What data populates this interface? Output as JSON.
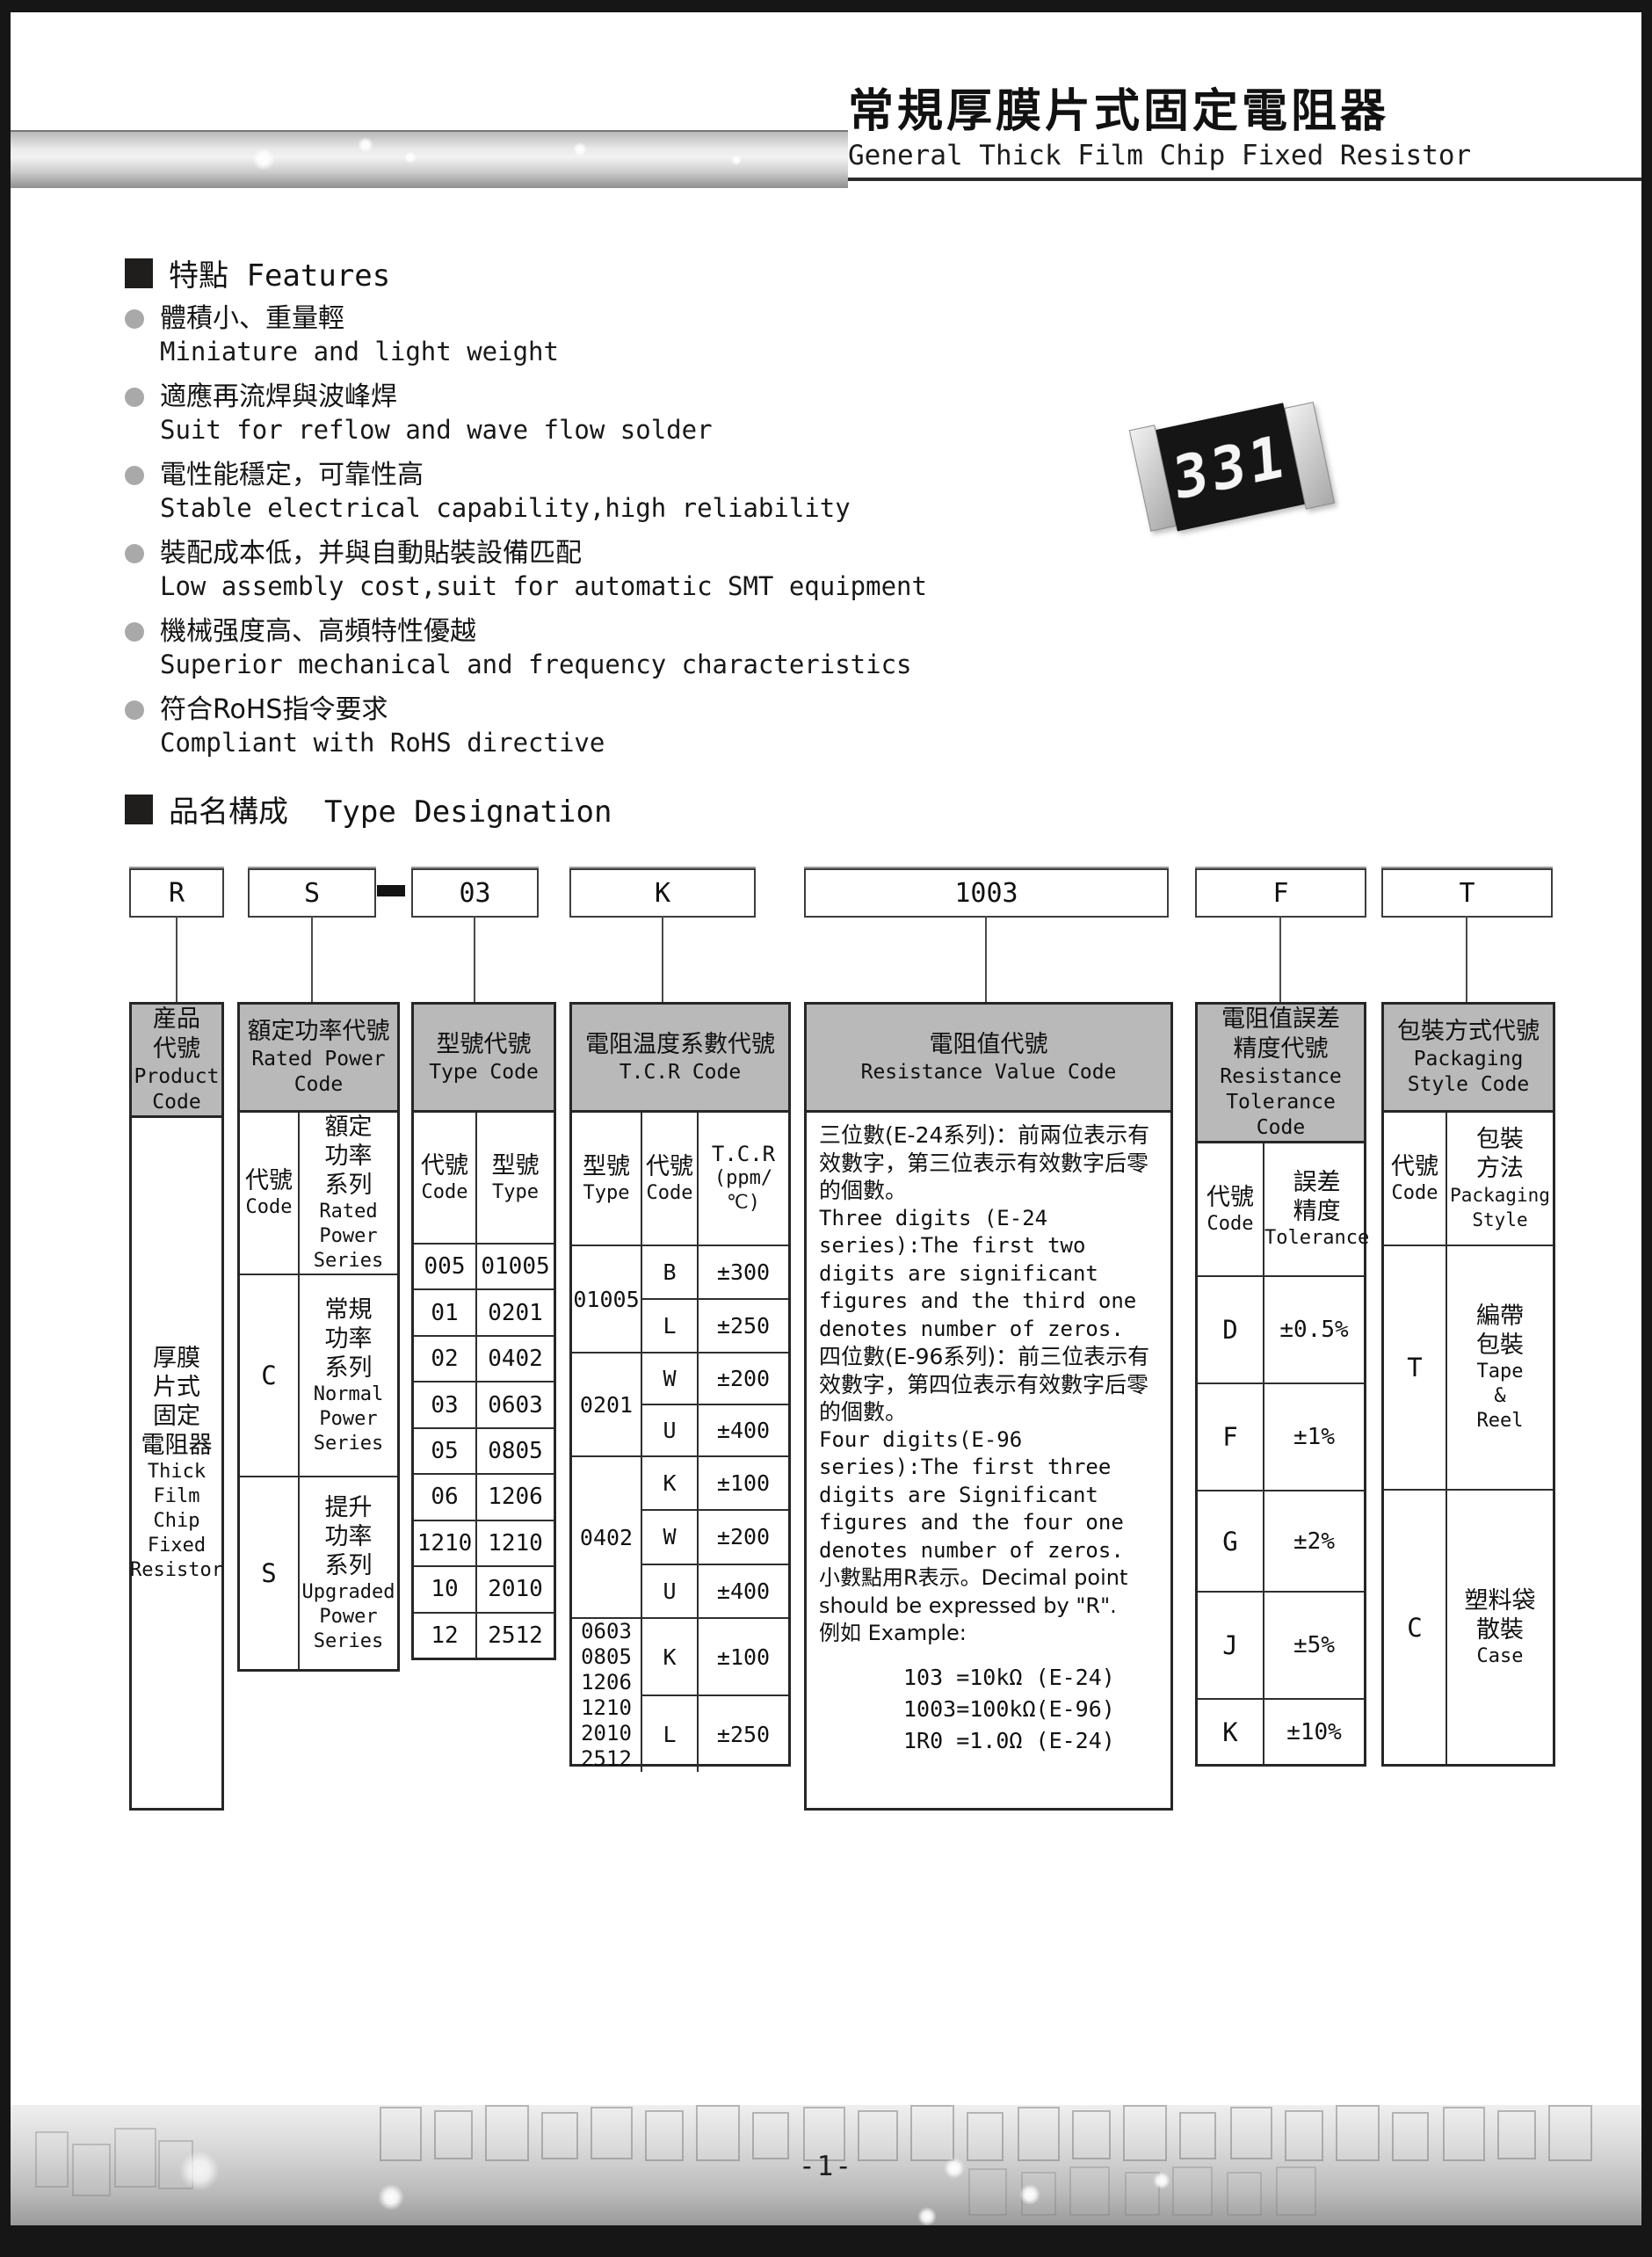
{
  "page": {
    "title_cn": "常規厚膜片式固定電阻器",
    "title_en": "General Thick Film Chip Fixed Resistor",
    "page_number": "-1-"
  },
  "features": {
    "heading_cn": "特點",
    "heading_en": "Features",
    "items": [
      {
        "cn": "體積小、重量輕",
        "en": "Miniature and light weight"
      },
      {
        "cn": "適應再流焊與波峰焊",
        "en": "Suit for reflow and wave flow solder"
      },
      {
        "cn": "電性能穩定，可靠性高",
        "en": "Stable electrical capability,high reliability"
      },
      {
        "cn": "裝配成本低，并與自動貼裝設備匹配",
        "en": "Low assembly cost,suit for automatic SMT equipment"
      },
      {
        "cn": "機械强度高、高頻特性優越",
        "en": "Superior mechanical and frequency characteristics"
      },
      {
        "cn": "符合RoHS指令要求",
        "en": "Compliant with RoHS directive"
      }
    ],
    "resistor_marking": "331"
  },
  "designation": {
    "heading_cn": "品名構成",
    "heading_en": "Type Designation",
    "codes": [
      "R",
      "S",
      "03",
      "K",
      "1003",
      "F",
      "T"
    ]
  },
  "table": {
    "product": {
      "header": [
        "産品",
        "代號",
        "Product",
        "Code"
      ],
      "body_cn": [
        "厚膜",
        "片式",
        "固定",
        "電阻器"
      ],
      "body_en": [
        "Thick",
        "Film",
        "Chip",
        "Fixed",
        "Resistor"
      ]
    },
    "rated_power": {
      "header": [
        "額定功率代號",
        "Rated Power",
        "Code"
      ],
      "sub_code_cn": "代號",
      "sub_code_en": "Code",
      "sub_series_cn": [
        "額定",
        "功率",
        "系列"
      ],
      "sub_series_en": [
        "Rated",
        "Power",
        "Series"
      ],
      "rows": [
        {
          "code": "C",
          "cn": [
            "常規",
            "功率",
            "系列"
          ],
          "en": [
            "Normal",
            "Power",
            "Series"
          ]
        },
        {
          "code": "S",
          "cn": [
            "提升",
            "功率",
            "系列"
          ],
          "en": [
            "Upgraded",
            "Power",
            "Series"
          ]
        }
      ]
    },
    "type_code": {
      "header": [
        "型號代號",
        "Type Code"
      ],
      "sub1_cn": "代號",
      "sub1_en": "Code",
      "sub2_cn": "型號",
      "sub2_en": "Type",
      "rows": [
        [
          "005",
          "01005"
        ],
        [
          "01",
          "0201"
        ],
        [
          "02",
          "0402"
        ],
        [
          "03",
          "0603"
        ],
        [
          "05",
          "0805"
        ],
        [
          "06",
          "1206"
        ],
        [
          "1210",
          "1210"
        ],
        [
          "10",
          "2010"
        ],
        [
          "12",
          "2512"
        ]
      ]
    },
    "tcr": {
      "header": [
        "電阻温度系數代號",
        "T.C.R Code"
      ],
      "sub1_cn": "型號",
      "sub1_en": "Type",
      "sub2_cn": "代號",
      "sub2_en": "Code",
      "sub3a": "T.C.R",
      "sub3b": "(ppm/℃)",
      "groups": [
        {
          "type": [
            "01005"
          ],
          "rows": [
            [
              "B",
              "±300"
            ],
            [
              "L",
              "±250"
            ]
          ]
        },
        {
          "type": [
            "0201"
          ],
          "rows": [
            [
              "W",
              "±200"
            ],
            [
              "U",
              "±400"
            ]
          ]
        },
        {
          "type": [
            "0402"
          ],
          "rows": [
            [
              "K",
              "±100"
            ],
            [
              "W",
              "±200"
            ],
            [
              "U",
              "±400"
            ]
          ]
        },
        {
          "type": [
            "0603",
            "0805",
            "1206",
            "1210",
            "2010",
            "2512"
          ],
          "rows": [
            [
              "K",
              "±100"
            ],
            [
              "L",
              "±250"
            ]
          ]
        }
      ]
    },
    "resistance_value": {
      "header": [
        "電阻值代號",
        "Resistance Value Code"
      ],
      "lines": [
        "三位數(E-24系列)：前兩位表示有效數字，第三位表示有效數字后零的個數。",
        "Three digits (E-24 series):The first two digits are significant figures and the third one denotes number of zeros.",
        "四位數(E-96系列)：前三位表示有效數字，第四位表示有效數字后零的個數。",
        "Four digits(E-96 series):The first three digits are Significant figures and the four one denotes number of zeros.",
        "小數點用R表示。Decimal point should be expressed by \"R\".",
        "例如 Example:"
      ],
      "examples": [
        "103  =10kΩ (E-24)",
        "1003=100kΩ(E-96)",
        "1R0 =1.0Ω  (E-24)"
      ]
    },
    "tolerance": {
      "header": [
        "電阻值誤差",
        "精度代號",
        "Resistance",
        "Tolerance Code"
      ],
      "sub1_cn": "代號",
      "sub1_en": "Code",
      "sub2_cn": [
        "誤差",
        "精度"
      ],
      "sub2_en": "Tolerance",
      "rows": [
        [
          "D",
          "±0.5%"
        ],
        [
          "F",
          "±1%"
        ],
        [
          "G",
          "±2%"
        ],
        [
          "J",
          "±5%"
        ],
        [
          "K",
          "±10%"
        ]
      ]
    },
    "packaging": {
      "header": [
        "包裝方式代號",
        "Packaging",
        "Style Code"
      ],
      "sub1_cn": "代號",
      "sub1_en": "Code",
      "sub2_cn": [
        "包裝",
        "方法"
      ],
      "sub2_en": [
        "Packaging",
        "Style"
      ],
      "rows": [
        {
          "code": "T",
          "cn": [
            "編帶",
            "包裝"
          ],
          "en": [
            "Tape",
            "&",
            "Reel"
          ]
        },
        {
          "code": "C",
          "cn": [
            "塑料袋",
            "散裝"
          ],
          "en": [
            "Case"
          ]
        }
      ]
    }
  }
}
